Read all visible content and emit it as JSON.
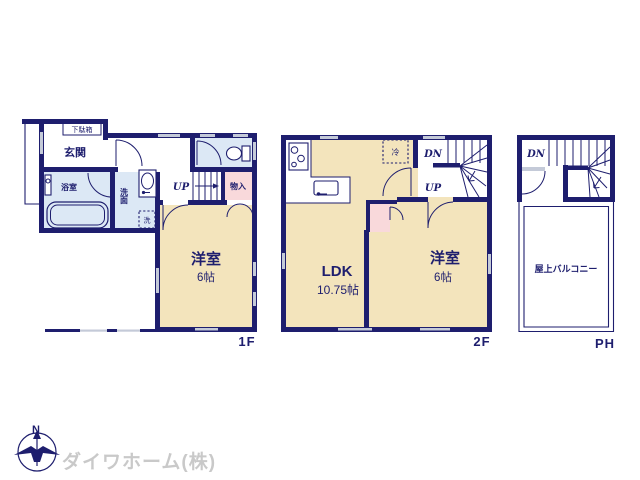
{
  "document": {
    "type": "floor-plan",
    "watermark": "ダイワホーム(株)",
    "compass_label": "N"
  },
  "colors": {
    "wall_navy": "#1e1e6e",
    "room_beige": "#f3e4bc",
    "room_lightblue": "#dce8f5",
    "room_pink": "#f9d9db",
    "window_gray": "#c4cad8",
    "watermark_gray": "#c9c9c9",
    "background": "#ffffff"
  },
  "floor_1f": {
    "label": "1F",
    "rooms": {
      "shoe_box": "下駄箱",
      "entrance": "玄関",
      "bathroom": "浴室",
      "washroom": "洗面",
      "washer": "洗",
      "stairs_up": "UP",
      "storage": "物入",
      "western_room_name": "洋室",
      "western_room_size": "6帖"
    }
  },
  "floor_2f": {
    "label": "2F",
    "rooms": {
      "refrigerator": "冷",
      "stairs_down": "DN",
      "stairs_up": "UP",
      "ldk_name": "LDK",
      "ldk_size": "10.75帖",
      "western_room_name": "洋室",
      "western_room_size": "6帖"
    }
  },
  "floor_ph": {
    "label": "PH",
    "rooms": {
      "stairs_down": "DN",
      "roof_balcony": "屋上バルコニー"
    }
  }
}
